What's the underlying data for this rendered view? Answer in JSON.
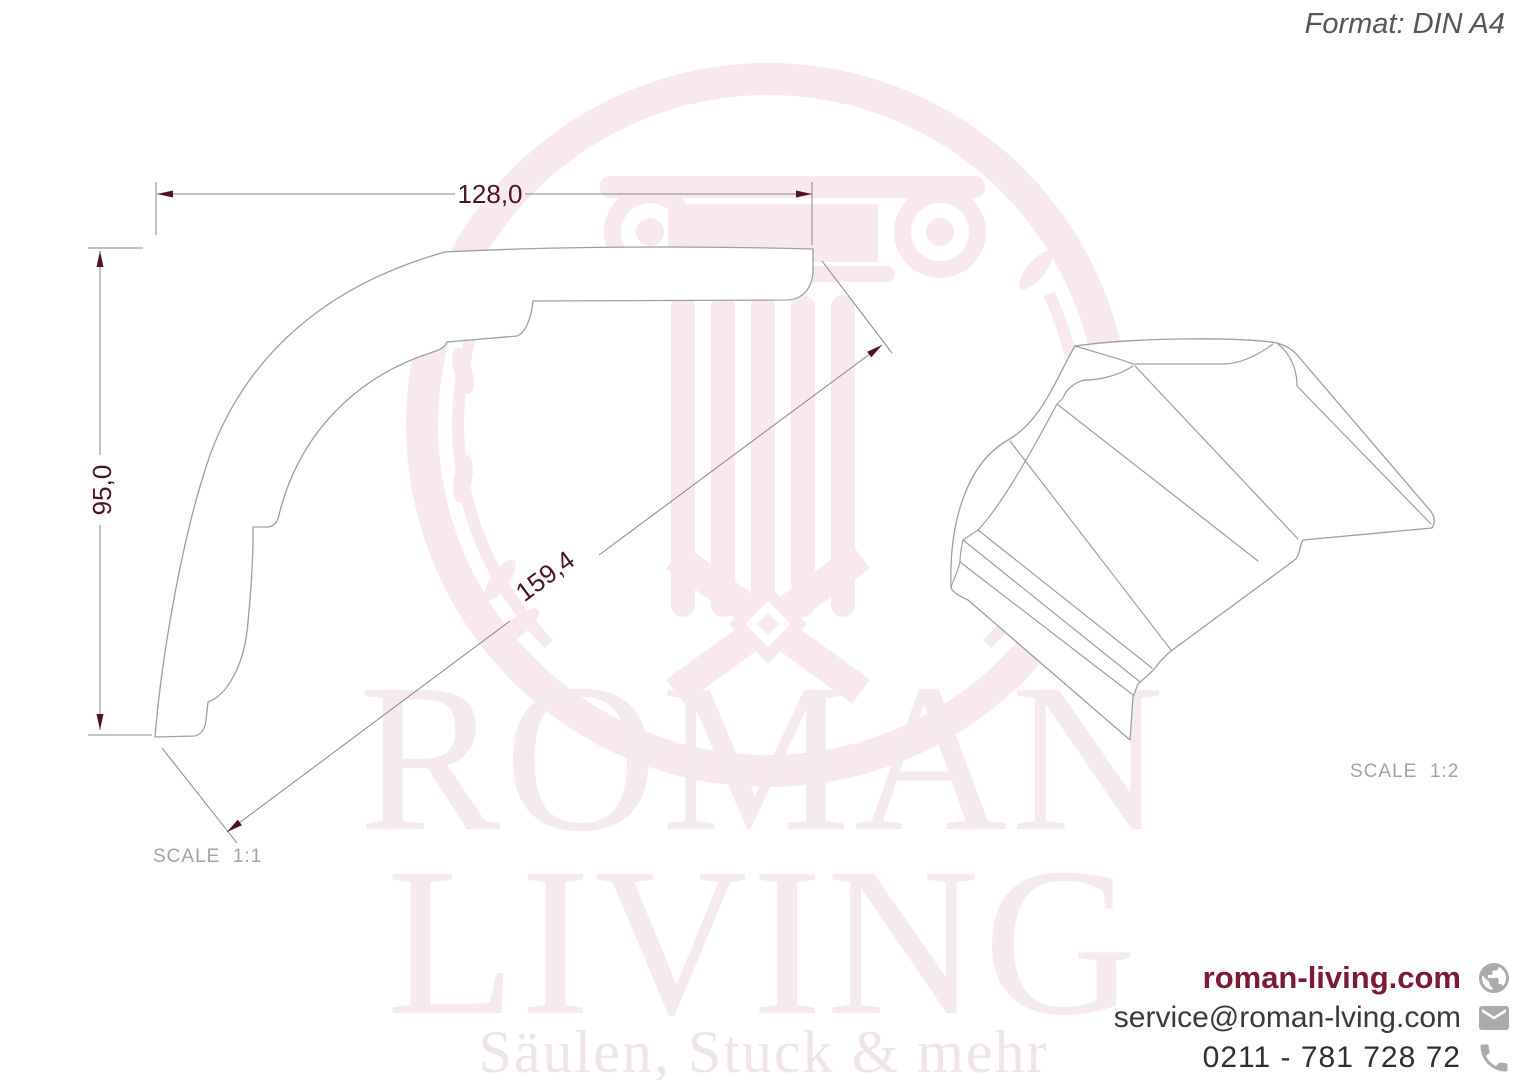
{
  "header": {
    "format_label": "Format: DIN A4"
  },
  "drawing": {
    "dim_width": "128,0",
    "dim_height": "95,0",
    "dim_diagonal": "159,4",
    "scale_left": "SCALE  1:1",
    "scale_right": "SCALE  1:2"
  },
  "watermark": {
    "word1": "ROMAN",
    "word2": "LIVING",
    "tagline": "Säulen, Stuck & mehr"
  },
  "footer": {
    "website": "roman-living.com",
    "email": "service@roman-lving.com",
    "phone": "0211 - 781 728 72"
  },
  "icons": [
    "globe-icon",
    "envelope-icon",
    "phone-icon"
  ],
  "colors": {
    "accent_maroon": "#7b1b33",
    "dimension_text": "#4e1322",
    "drawing_line_gray": "#9aa0a2",
    "dimension_line": "#8f8288",
    "label_gray": "#a3a3a3",
    "icon_gray": "#ababab",
    "watermark_pink": "#f7e9ed",
    "format_label_gray": "#55565b"
  }
}
